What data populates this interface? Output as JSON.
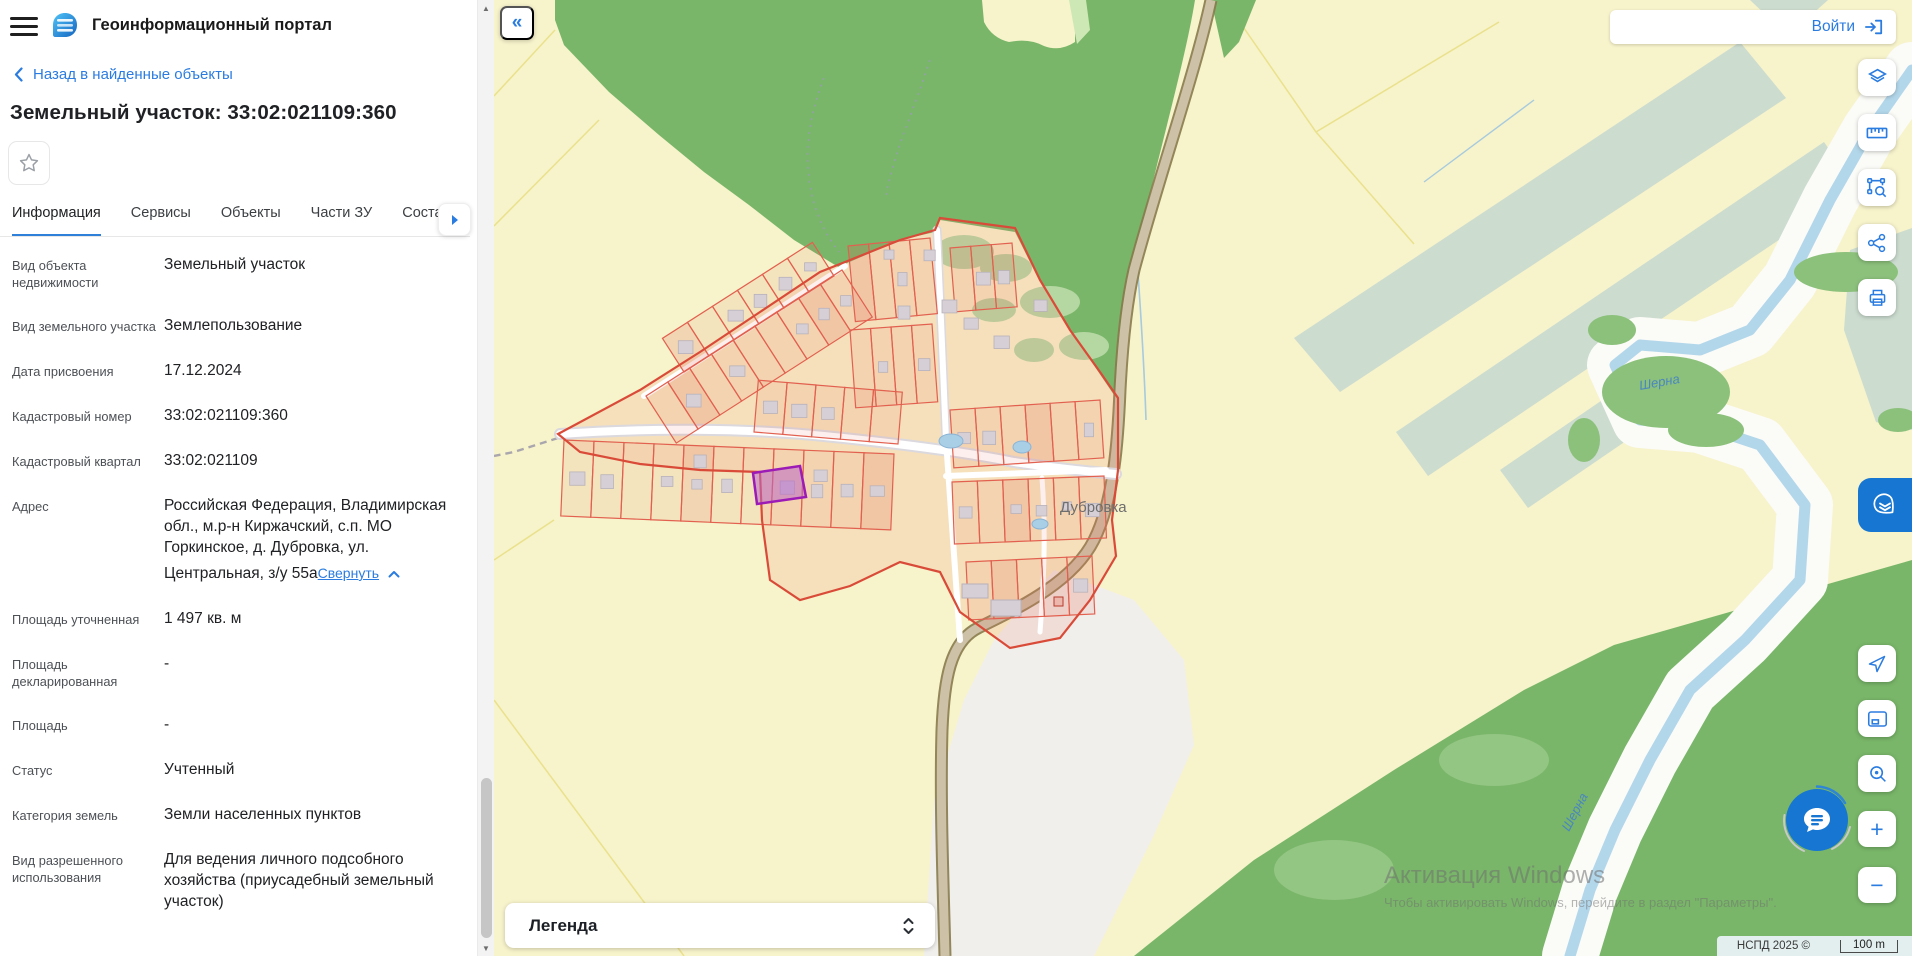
{
  "header": {
    "title": "Геоинформационный портал"
  },
  "back_link": {
    "label": "Назад в найденные объекты"
  },
  "page_title": "Земельный участок: 33:02:021109:360",
  "tabs": [
    "Информация",
    "Сервисы",
    "Объекты",
    "Части ЗУ",
    "Состав"
  ],
  "active_tab": 0,
  "fields": [
    {
      "label": "Вид объекта недвижимости",
      "value": "Земельный участок"
    },
    {
      "label": "Вид земельного участка",
      "value": "Землепользование"
    },
    {
      "label": "Дата присвоения",
      "value": "17.12.2024"
    },
    {
      "label": "Кадастровый номер",
      "value": "33:02:021109:360"
    },
    {
      "label": "Кадастровый квартал",
      "value": "33:02:021109"
    },
    {
      "label": "Адрес",
      "value": "Российская Федерация, Владимирская обл., м.р-н Киржачский, с.п. МО Горкинское, д. Дубровка, ул. Центральная, з/у 55а",
      "link": "Свернуть"
    },
    {
      "label": "Площадь уточненная",
      "value": "1 497 кв. м"
    },
    {
      "label": "Площадь декларированная",
      "value": "-"
    },
    {
      "label": "Площадь",
      "value": "-"
    },
    {
      "label": "Статус",
      "value": "Учтенный"
    },
    {
      "label": "Категория земель",
      "value": "Земли населенных пунктов"
    },
    {
      "label": "Вид разрешенного использования",
      "value": "Для ведения личного подсобного хозяйства (приусадебный земельный участок)"
    }
  ],
  "login": {
    "label": "Войти"
  },
  "legend": {
    "label": "Легенда"
  },
  "map": {
    "village_label": "Дубровка",
    "river_label": "Шерна",
    "attribution": "НСПД 2025 ©",
    "scale_text": "100 m"
  },
  "icons": {
    "collapse": "«",
    "zoom_in": "+",
    "zoom_out": "−",
    "scroll_up": "▲",
    "scroll_down": "▼"
  },
  "watermark": {
    "line1": "Активация Windows",
    "line2": "Чтобы активировать Windows, перейдите в раздел \"Параметры\"."
  },
  "colors": {
    "accent_blue": "#2b7ce0",
    "tab_underline": "#2f80d9",
    "parcel_stroke": "#e2604f",
    "selected_parcel": "#9c1ab5",
    "forest": "#79b669",
    "field_yellow": "#f7f3cb",
    "river": "#b3d7ea"
  }
}
